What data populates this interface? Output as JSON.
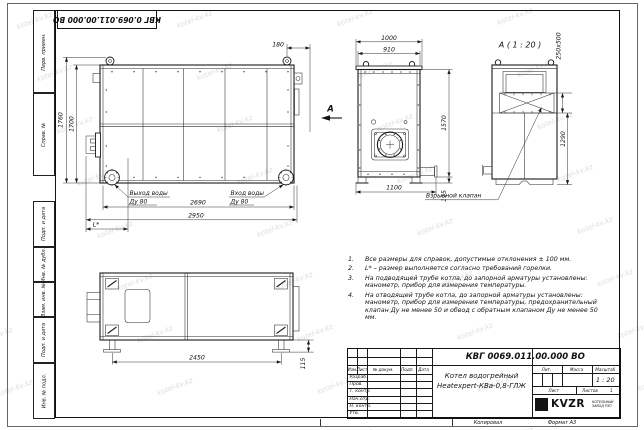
{
  "colors": {
    "line": "#1a1a1a",
    "background": "#ffffff",
    "watermark": "#a5b4bd"
  },
  "watermark": {
    "text": "kotel-kv.kz"
  },
  "corner_stamp": {
    "doc_number_rotated": "КВГ 0.069.011.00.000 ВО"
  },
  "margin_stamps": [
    "Перв. примен.",
    "Справ. №",
    "Подп. и дата",
    "Инв. № дубл.",
    "Взам. инв. №",
    "Подп. и дата",
    "Инв. № подл."
  ],
  "views": {
    "side": {
      "dims": {
        "height_overall": "1760",
        "height_body": "1700",
        "top_offset": "180",
        "length_body": "2690",
        "length_overall": "2950",
        "burner_dim": "L*"
      },
      "labels": {
        "outlet_line1": "Выход воды",
        "outlet_line2": "Ду 80",
        "inlet_line1": "Вход воды",
        "inlet_line2": "Ду 80",
        "view_letter": "А"
      }
    },
    "front": {
      "dims": {
        "width_overall": "1000",
        "width_body": "910",
        "height": "1570",
        "base_width": "1100",
        "leg_height": "115"
      }
    },
    "detail_a": {
      "title": "А ( 1 : 20 )",
      "dims": {
        "valve_size": "250х500",
        "height": "1290"
      },
      "label_valve": "Взрывной клапан"
    },
    "plan": {
      "dims": {
        "feet_spacing": "2450",
        "leg_height": "115"
      }
    }
  },
  "notes": [
    {
      "num": "1.",
      "text": "Все размеры для справок, допустимые отклонения ± 100 мм."
    },
    {
      "num": "2.",
      "text": "L* – размер выполняется согласно требований горелки."
    },
    {
      "num": "3.",
      "text": "На подводящей трубе котла, до запорной арматуры установлены: манометр, прибор для измерения температуры."
    },
    {
      "num": "4.",
      "text": "На отводящей трубе котла, до запорной арматуры установлены: манометр, прибор для измерения температуры, предохранительный клапан Ду не менее 50 и обвод с обратным клапаном Ду не менее 50 мм."
    }
  ],
  "title_block": {
    "doc_number": "КВГ 0069.011.00.000 ВО",
    "product_name_line1": "Котел водогрейный",
    "product_name_line2": "Heatexpert-КВа-0,8-ГЛЖ",
    "header_cells": [
      "Изм.",
      "Лист",
      "№ докум.",
      "Подп.",
      "Дата"
    ],
    "signature_rows": [
      "Разраб.",
      "Пров.",
      "Т. контр.",
      "Нач.отд.",
      "Н. контр.",
      "Утв."
    ],
    "lit_label": "Лит.",
    "mass_label": "Масса",
    "scale_label": "Масштаб",
    "scale_value": "1 : 20",
    "sheet_label": "Лист",
    "sheets_label": "Листов",
    "sheets_value": "1",
    "logo_text": "KVZR",
    "company_line1": "КОТЕЛЬНЫЙ",
    "company_line2": "ЗАВОД РЭП"
  },
  "footer": {
    "copied_label": "Копировал",
    "format_label": "Формат А3"
  }
}
